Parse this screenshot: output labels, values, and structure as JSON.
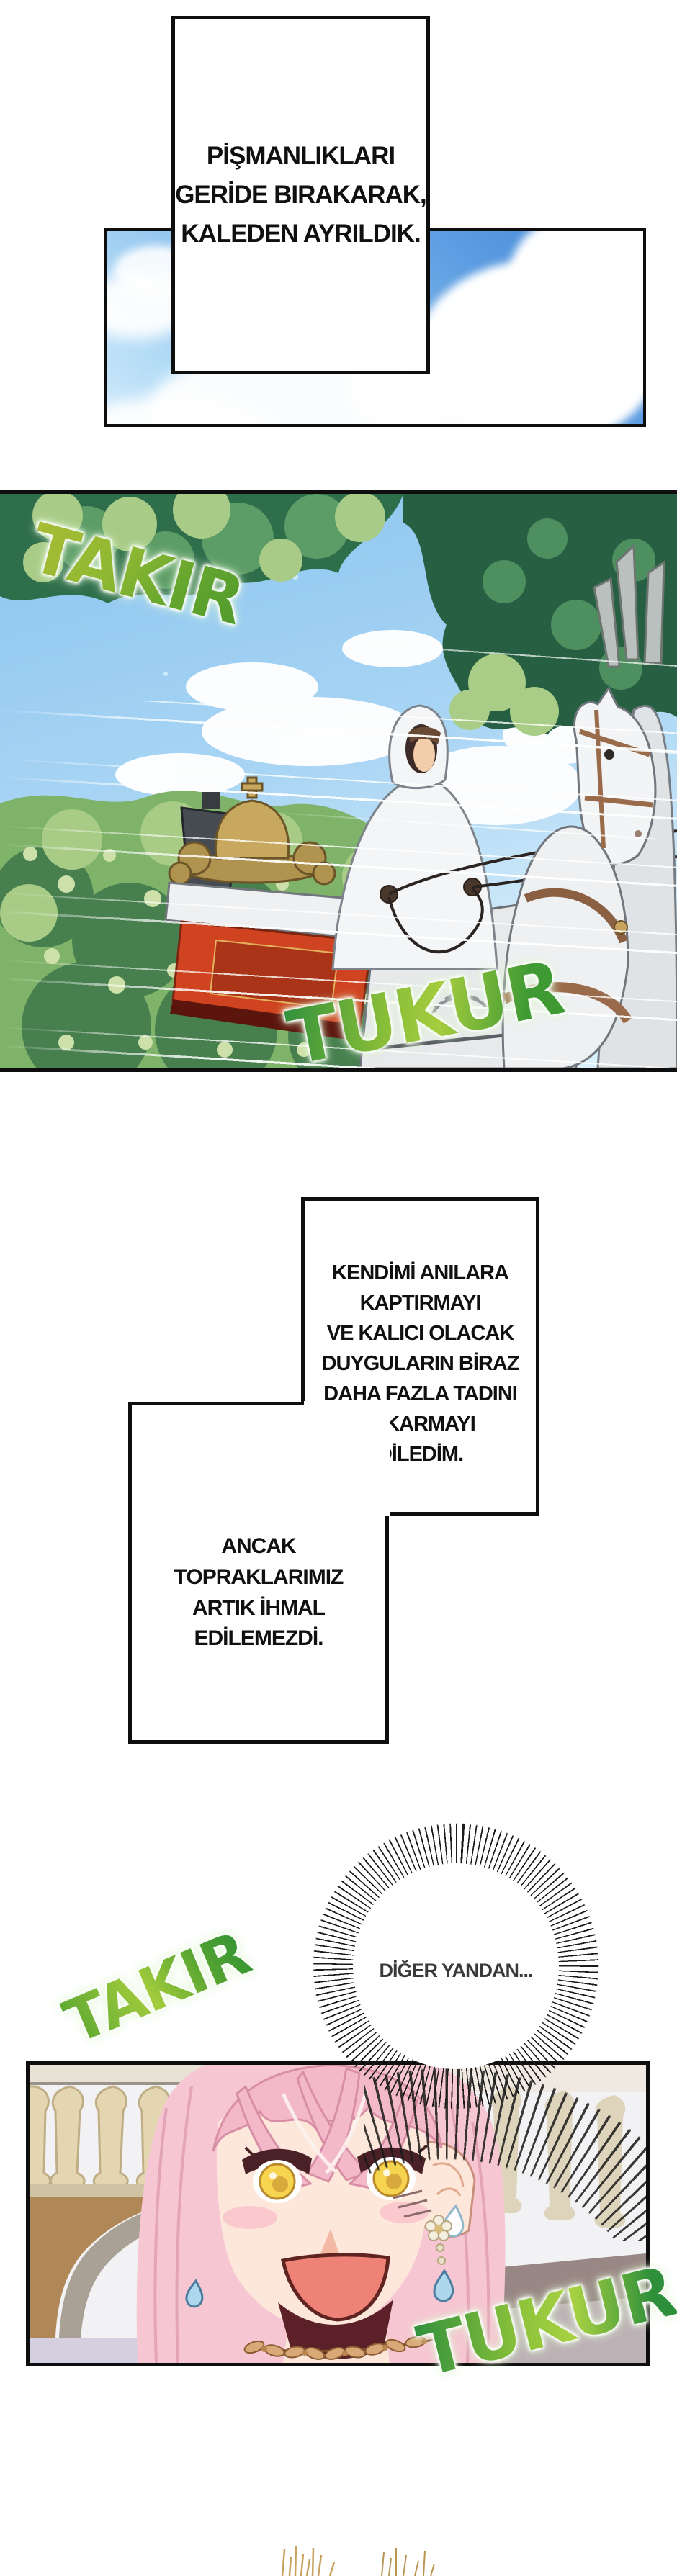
{
  "page_title": "Webtoon sayfası",
  "narration1": {
    "lines": [
      "PİŞMANLIKLARI",
      "GERİDE BIRAKARAK,",
      "KALEDEN AYRILDIK."
    ]
  },
  "narration2": {
    "lines": [
      "KENDİMİ ANILARA",
      "KAPTIRMAYI",
      "VE KALICI OLACAK",
      "DUYGULARIN BİRAZ",
      "DAHA FAZLA TADINI",
      "ÇIKARMAYI",
      "DİLEDİM."
    ]
  },
  "narration3": {
    "lines": [
      "ANCAK",
      "TOPRAKLARIMIZ",
      "ARTIK İHMAL",
      "EDİLEMEZDİ."
    ]
  },
  "burst": {
    "text": "DİĞER YANDAN..."
  },
  "sfx": {
    "takir_top": "TAKIR",
    "tukur_top": "TUKUR",
    "takir_bottom": "TAKIR",
    "tukur_bottom": "TUKUR"
  },
  "palette": {
    "panel_border": "#0e0e0e",
    "sky_deep_blue": "#3d85d8",
    "sky_light_blue": "#cfeafa",
    "sfx_green_light": "#a9d243",
    "sfx_green_dark": "#2f8f3c",
    "foliage_dark": "#275f43",
    "foliage_mid": "#7fb369",
    "foliage_light": "#cde0a9",
    "carriage_red": "#cf4320",
    "carriage_gold": "#c7a85e",
    "hair_pink": "#f6c6d2",
    "eye_yellow": "#f6d44f",
    "skin": "#fde7da",
    "mouth_coral": "#ef8277",
    "wall_tan": "#b08756",
    "wall_mauve": "#b7abaf",
    "grass_tan": "#c9a25e"
  }
}
